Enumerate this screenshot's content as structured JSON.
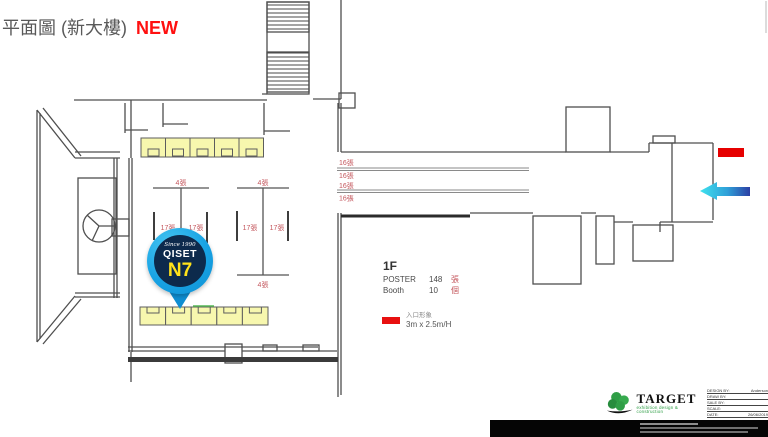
{
  "header": {
    "title": "平面圖 (新大樓)",
    "badge": "NEW"
  },
  "pin": {
    "since": "Since 1990",
    "brand": "QISET",
    "booth": "N7"
  },
  "floor_info": {
    "floor": "1F",
    "rows": [
      {
        "label": "POSTER",
        "count": "148",
        "unit": "張"
      },
      {
        "label": "Booth",
        "count": "10",
        "unit": "個"
      }
    ]
  },
  "legend": {
    "title": "入口形象",
    "size": "3m x 2.5m/H"
  },
  "plan_labels": {
    "island1_top": "4張",
    "island1_left": "17張",
    "island1_right": "17張",
    "island2_top": "4張",
    "island2_left": "17張",
    "island2_right": "17張",
    "island2_bottom": "4張",
    "corridor_row1_top": "16張",
    "corridor_row1_bottom": "16張",
    "corridor_row2_top": "16張",
    "corridor_row2_bottom": "16張"
  },
  "colors": {
    "accent_red": "#e60000",
    "label_red": "#c4565c",
    "booth_yellow": "#f7f7ae",
    "pin_blue": "#18a3e4",
    "pin_navy": "#0d2a4c",
    "booth_no_yellow": "#ffe21a",
    "brand_green": "#2f9e46"
  },
  "footer": {
    "brand": "TARGET",
    "tagline": "exhibition design & construction",
    "table": [
      {
        "label": "DESIGN BY:",
        "value": "Anderson"
      },
      {
        "label": "DRAW BY:",
        "value": ""
      },
      {
        "label": "SALE BY:",
        "value": ""
      },
      {
        "label": "SCALE:",
        "value": ""
      },
      {
        "label": "DATE:",
        "value": "26/06/2019"
      }
    ]
  }
}
